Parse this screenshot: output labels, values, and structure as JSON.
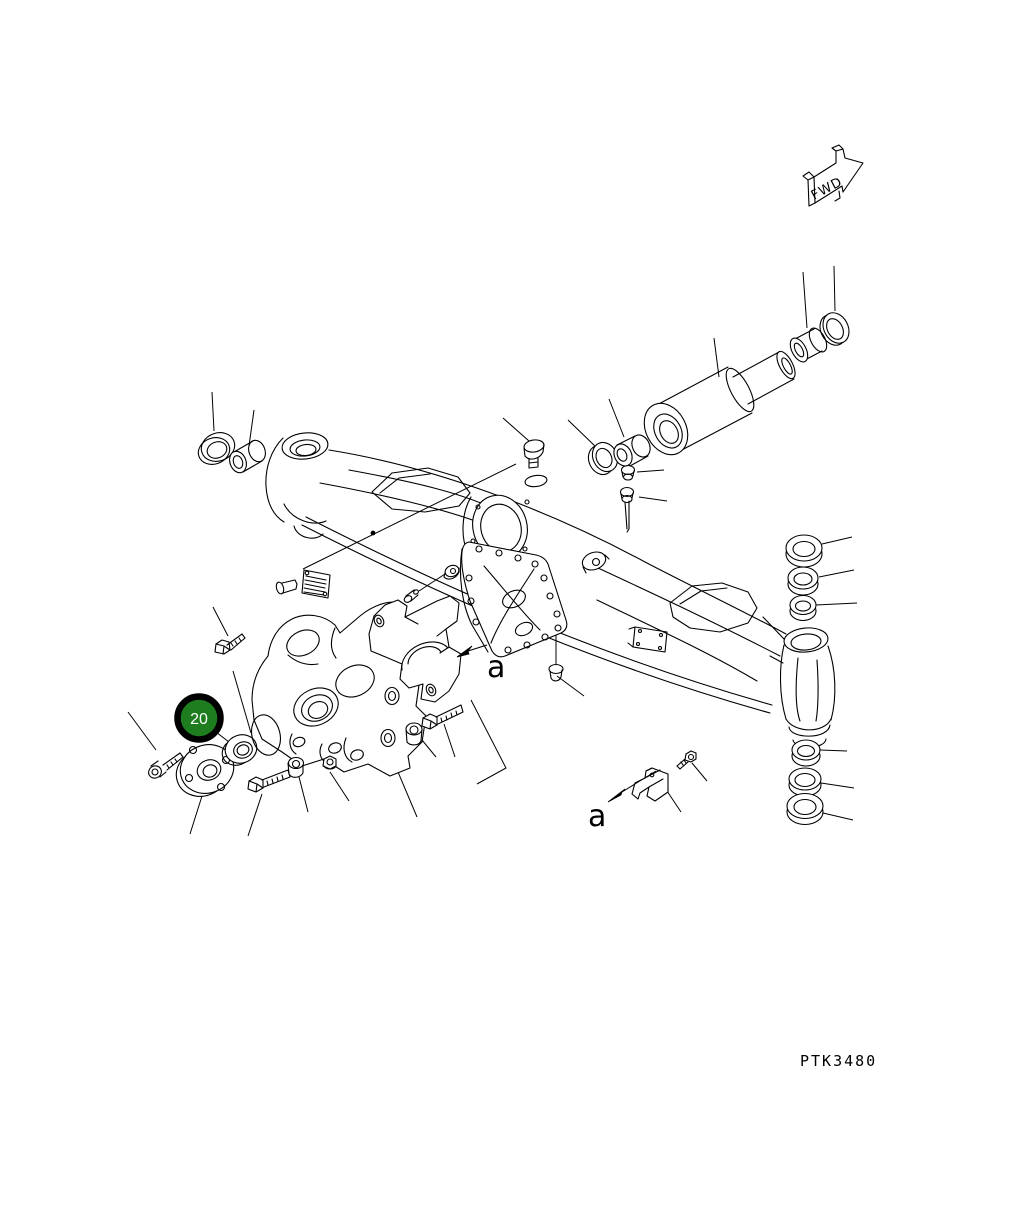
{
  "figure": {
    "drawing_code": "PTK3480",
    "fwd_label": "FWD",
    "balloon": {
      "number": "20",
      "fill": "#1e7d1e",
      "ring": "#000000",
      "text_color": "#ffffff"
    },
    "view_labels": [
      {
        "label": "a"
      },
      {
        "label": "a"
      }
    ],
    "ink_color": "#000000",
    "background_color": "#ffffff"
  }
}
